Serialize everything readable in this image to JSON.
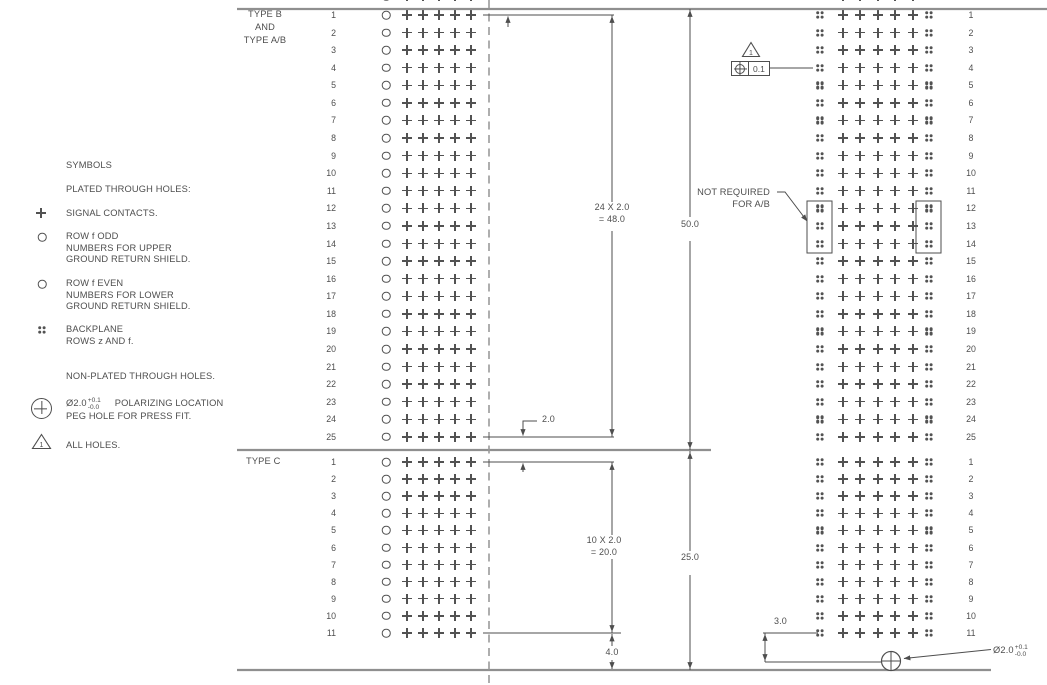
{
  "drawing": {
    "background": "#ffffff",
    "ink_color": "#4e4e4e",
    "symbol_color": "#525252",
    "structural_line_color": "#8f8f8f"
  },
  "legend": {
    "title": "SYMBOLS",
    "plated_heading": "PLATED THROUGH HOLES:",
    "signal": {
      "lines": [
        "SIGNAL CONTACTS."
      ]
    },
    "row_odd": {
      "lines": [
        "ROW f ODD",
        "NUMBERS FOR UPPER",
        "GROUND RETURN SHIELD."
      ]
    },
    "row_even": {
      "lines": [
        "ROW f EVEN",
        "NUMBERS FOR LOWER",
        "GROUND RETURN SHIELD."
      ]
    },
    "backplane": {
      "lines": [
        "BACKPLANE",
        "ROWS z AND f."
      ]
    },
    "nonplated_heading": "NON-PLATED THROUGH HOLES.",
    "peg": {
      "dia": "Ø2.0",
      "tol_plus": "+0.1",
      "tol_minus": "-0.0",
      "line1": "POLARIZING LOCATION",
      "line2": "PEG HOLE FOR PRESS FIT."
    },
    "all_holes": {
      "flag": "1",
      "text": "ALL HOLES."
    }
  },
  "grid": {
    "sections": [
      {
        "label_lines": [
          "TYPE B",
          "AND",
          "TYPE A/B"
        ],
        "row_numbers": [
          1,
          2,
          3,
          4,
          5,
          6,
          7,
          8,
          9,
          10,
          11,
          12,
          13,
          14,
          15,
          16,
          17,
          18,
          19,
          20,
          21,
          22,
          23,
          24,
          25
        ]
      },
      {
        "label_lines": [
          "TYPE C"
        ],
        "row_numbers": [
          1,
          2,
          3,
          4,
          5,
          6,
          7,
          8,
          9,
          10,
          11
        ]
      }
    ]
  },
  "callouts": {
    "not_required": [
      "NOT REQUIRED",
      "FOR A/B"
    ],
    "fcf": {
      "flag": "1",
      "value": "0.1"
    }
  },
  "dimensions": {
    "b_pitch": [
      "24 X 2.0",
      "= 48.0"
    ],
    "b_height": "50.0",
    "row_gap": "2.0",
    "c_pitch": [
      "10 X 2.0",
      "= 20.0"
    ],
    "c_height": "25.0",
    "bottom_offset": "4.0",
    "peg_offset": "3.0",
    "peg_dia": "Ø2.0",
    "peg_tol_plus": "+0.1",
    "peg_tol_minus": "-0.0"
  }
}
